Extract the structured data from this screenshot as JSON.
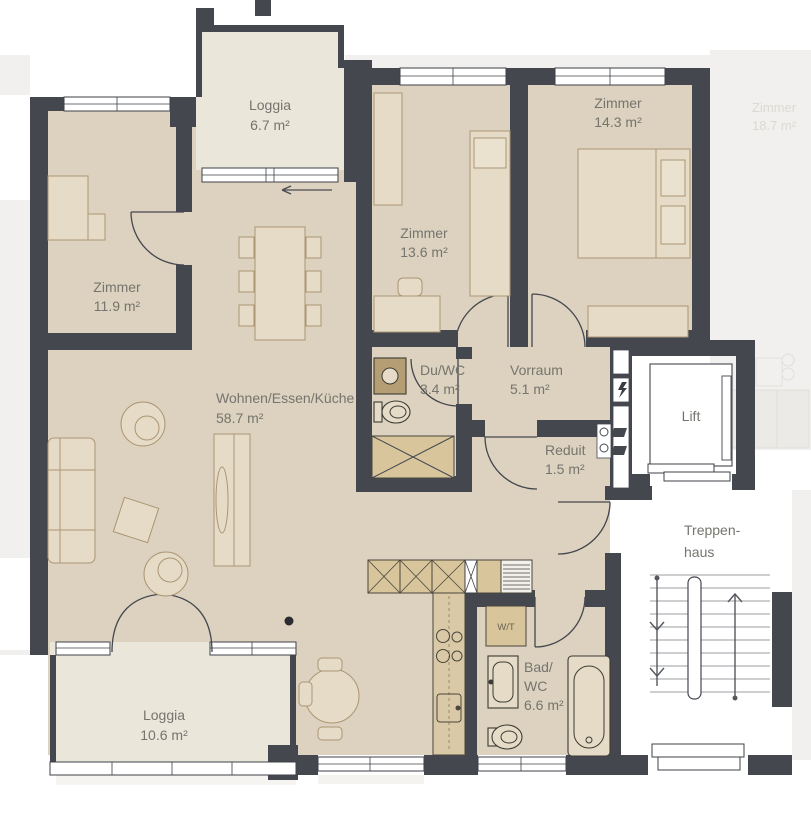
{
  "labels": {
    "loggia_top": {
      "name": "Loggia",
      "area": "6.7 m²"
    },
    "zimmer_west": {
      "name": "Zimmer",
      "area": "11.9 m²"
    },
    "zimmer_mid": {
      "name": "Zimmer",
      "area": "13.6 m²"
    },
    "zimmer_east": {
      "name": "Zimmer",
      "area": "14.3 m²"
    },
    "wohnen": {
      "name": "Wohnen/Essen/Küche",
      "area": "58.7 m²"
    },
    "du_wc": {
      "name": "Du/WC",
      "area": "3.4 m²"
    },
    "vorraum": {
      "name": "Vorraum",
      "area": "5.1 m²"
    },
    "reduit": {
      "name": "Reduit",
      "area": "1.5 m²"
    },
    "lift": {
      "name": "Lift"
    },
    "treppenhaus": {
      "line1": "Treppen-",
      "line2": "haus"
    },
    "loggia_bottom": {
      "name": "Loggia",
      "area": "10.6 m²"
    },
    "bad_wc": {
      "line1": "Bad/",
      "line2": "WC",
      "area": "6.6 m²"
    },
    "wt_closet": {
      "name": "W/T"
    },
    "neighbor_zimmer": {
      "name": "Zimmer",
      "area": "18.7 m²"
    }
  },
  "icons": {
    "shaft_symbol": "lightning-bolt",
    "stair_direction_up": "arrow-up",
    "stair_direction_down": "arrow-down",
    "slider_direction": "arrow-left"
  },
  "colors": {
    "wall": "#45474f",
    "room_fill": "#dcd2bf",
    "loggia_fill": "#eae6da",
    "furniture_fill": "#e5dbc6",
    "furniture_stroke": "#ab9674",
    "cabinet_fill": "#d8c59c",
    "label_text": "#75746e",
    "faded_fill": "#f1f0ee",
    "faded_text": "#dcd9d1"
  }
}
